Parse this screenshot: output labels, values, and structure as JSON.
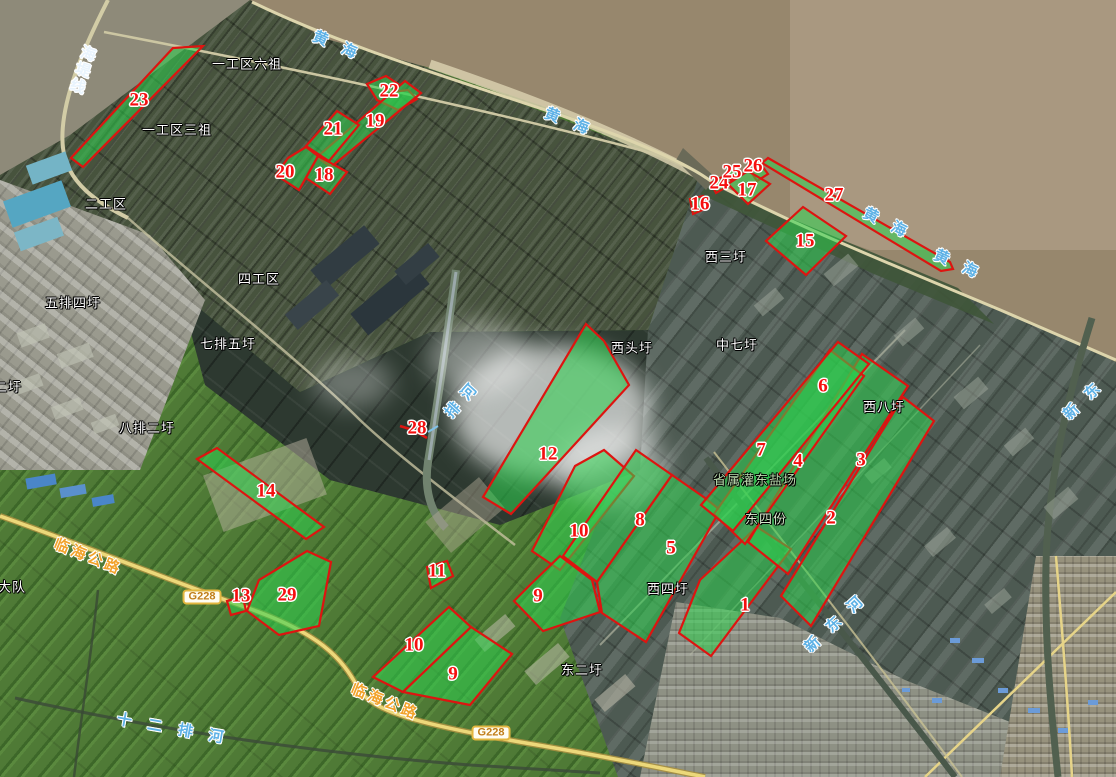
{
  "map": {
    "title": "灌东盐场卫星影像分布图",
    "colors": {
      "parcel_fill": "#2ed24e",
      "parcel_stroke": "#de1410",
      "marker_red": "#f50f0f",
      "water_label_blue": "#5fb2e6",
      "road_label_orange": "#f2a32c",
      "sea_brown": "#97876d",
      "sea_light_seam": "#ab9a82",
      "farmland_green": "#4f7a36",
      "highway_yellow": "#ecd87a"
    },
    "region_labels": [
      {
        "t": "一工区六祖",
        "x": 247,
        "y": 64
      },
      {
        "t": "一工区三祖",
        "x": 177,
        "y": 130
      },
      {
        "t": "二工区",
        "x": 106,
        "y": 204
      },
      {
        "t": "四工区",
        "x": 259,
        "y": 279
      },
      {
        "t": "五排四圩",
        "x": 73,
        "y": 303
      },
      {
        "t": "七排五圩",
        "x": 228,
        "y": 344
      },
      {
        "t": "八排二圩",
        "x": 147,
        "y": 428
      },
      {
        "t": "二圩",
        "x": 8,
        "y": 387
      },
      {
        "t": "西三圩",
        "x": 726,
        "y": 257
      },
      {
        "t": "西头圩",
        "x": 632,
        "y": 348
      },
      {
        "t": "中七圩",
        "x": 737,
        "y": 345
      },
      {
        "t": "西八圩",
        "x": 884,
        "y": 407
      },
      {
        "t": "省属灌东盐场",
        "x": 755,
        "y": 480,
        "c": "#b9d9ac"
      },
      {
        "t": "东四份",
        "x": 766,
        "y": 519,
        "c": "#d6e8cc"
      },
      {
        "t": "西四圩",
        "x": 668,
        "y": 589
      },
      {
        "t": "东二圩",
        "x": 582,
        "y": 670
      },
      {
        "t": "大队",
        "x": 12,
        "y": 587
      }
    ],
    "water_labels": [
      {
        "t": "海堤线",
        "x": 82,
        "y": 70,
        "r": 18,
        "v": true,
        "ls": 2,
        "c": "#e9f4fd"
      },
      {
        "t": "黄海",
        "x": 342,
        "y": 48,
        "r": 23,
        "ls": 16
      },
      {
        "t": "黄海",
        "x": 574,
        "y": 124,
        "r": 21,
        "ls": 16
      },
      {
        "t": "黄海",
        "x": 892,
        "y": 226,
        "r": 26,
        "ls": 16
      },
      {
        "t": "黄海",
        "x": 963,
        "y": 267,
        "r": 24,
        "ls": 16
      },
      {
        "t": "排河",
        "x": 464,
        "y": 398,
        "r": -48,
        "ls": 9
      },
      {
        "t": "新东河",
        "x": 839,
        "y": 620,
        "r": -43,
        "ls": 14
      },
      {
        "t": "新东",
        "x": 1087,
        "y": 397,
        "r": -44,
        "ls": 14
      },
      {
        "t": "十二排河",
        "x": 178,
        "y": 730,
        "r": 10,
        "ls": 16
      }
    ],
    "road_labels": [
      {
        "t": "临海公路",
        "x": 88,
        "y": 557,
        "r": 22,
        "ls": 3
      },
      {
        "t": "临海公路",
        "x": 385,
        "y": 702,
        "r": 22,
        "ls": 3
      }
    ],
    "road_badges": [
      {
        "t": "G228",
        "x": 202,
        "y": 597
      },
      {
        "t": "G228",
        "x": 491,
        "y": 733
      }
    ],
    "markers": [
      {
        "n": "1",
        "x": 745,
        "y": 605
      },
      {
        "n": "2",
        "x": 831,
        "y": 518
      },
      {
        "n": "3",
        "x": 861,
        "y": 460
      },
      {
        "n": "4",
        "x": 798,
        "y": 461
      },
      {
        "n": "5",
        "x": 671,
        "y": 548
      },
      {
        "n": "6",
        "x": 823,
        "y": 386
      },
      {
        "n": "7",
        "x": 761,
        "y": 450
      },
      {
        "n": "8",
        "x": 640,
        "y": 520
      },
      {
        "n": "9",
        "x": 538,
        "y": 596
      },
      {
        "n": "9",
        "x": 453,
        "y": 674,
        "dup": "-b"
      },
      {
        "n": "10",
        "x": 579,
        "y": 531
      },
      {
        "n": "10",
        "x": 414,
        "y": 645,
        "dup": "-b"
      },
      {
        "n": "11",
        "x": 437,
        "y": 571
      },
      {
        "n": "12",
        "x": 548,
        "y": 454
      },
      {
        "n": "13",
        "x": 241,
        "y": 596
      },
      {
        "n": "14",
        "x": 266,
        "y": 491
      },
      {
        "n": "15",
        "x": 805,
        "y": 241
      },
      {
        "n": "16",
        "x": 700,
        "y": 204
      },
      {
        "n": "17",
        "x": 747,
        "y": 190
      },
      {
        "n": "18",
        "x": 324,
        "y": 175
      },
      {
        "n": "19",
        "x": 375,
        "y": 121
      },
      {
        "n": "20",
        "x": 285,
        "y": 172
      },
      {
        "n": "21",
        "x": 333,
        "y": 129
      },
      {
        "n": "22",
        "x": 389,
        "y": 91
      },
      {
        "n": "23",
        "x": 139,
        "y": 100
      },
      {
        "n": "24",
        "x": 719,
        "y": 183
      },
      {
        "n": "25",
        "x": 732,
        "y": 172
      },
      {
        "n": "26",
        "x": 753,
        "y": 166
      },
      {
        "n": "27",
        "x": 834,
        "y": 195
      },
      {
        "n": "28",
        "x": 417,
        "y": 428
      },
      {
        "n": "29",
        "x": 287,
        "y": 595
      }
    ],
    "parcels": [
      {
        "id": "23",
        "points": "173,48 203,46 83,167 71,158"
      },
      {
        "id": "22",
        "points": "367,84 386,76 398,84 392,92 408,90 417,99 398,110 377,100"
      },
      {
        "id": "19",
        "points": "405,81 421,93 331,167 317,157"
      },
      {
        "id": "21",
        "points": "337,111 359,125 329,161 306,146"
      },
      {
        "id": "18",
        "points": "318,156 347,172 330,194 306,178"
      },
      {
        "id": "20",
        "points": "288,158 306,147 318,156 299,190 276,175"
      },
      {
        "id": "27",
        "points": "762,163 768,158 950,262 953,269 941,271"
      },
      {
        "id": "26",
        "points": "751,172 762,166 768,174 757,181"
      },
      {
        "id": "25",
        "points": "727,172 737,166 742,174 731,180"
      },
      {
        "id": "24",
        "points": "711,183 722,177 728,186 716,193"
      },
      {
        "id": "17",
        "points": "748,171 770,184 748,204 728,184"
      },
      {
        "id": "16",
        "points": "690,199 703,196 707,208 693,214"
      },
      {
        "id": "15",
        "points": "803,207 846,236 806,275 766,241"
      },
      {
        "id": "28",
        "points": "400,426 413,430 427,438",
        "open": true
      },
      {
        "id": "12",
        "points": "586,324 604,341 629,385 511,514 483,497"
      },
      {
        "id": "14",
        "points": "197,459 217,448 324,527 306,539"
      },
      {
        "id": "29",
        "points": "307,551 331,562 319,626 279,635 247,611 259,580"
      },
      {
        "id": "13",
        "points": "227,601 243,597 246,611 231,615"
      },
      {
        "id": "11",
        "points": "427,567 447,561 453,576 431,588"
      },
      {
        "id": "10",
        "points": "575,466 604,450 634,476 560,570 532,551"
      },
      {
        "id": "8",
        "points": "636,450 672,475 597,582 563,556"
      },
      {
        "id": "5",
        "points": "672,475 705,498 720,510 646,642 602,613 597,582"
      },
      {
        "id": "9",
        "points": "560,556 592,580 600,612 543,631 514,601 531,584"
      },
      {
        "id": "1",
        "points": "757,527 791,549 711,656 679,633 700,580"
      },
      {
        "id": "2",
        "points": "903,397 934,421 811,626 781,596"
      },
      {
        "id": "3",
        "points": "862,354 908,386 788,574 748,542"
      },
      {
        "id": "4",
        "points": "830,350 864,376 745,544 714,514"
      },
      {
        "id": "6-7",
        "points": "838,342 869,364 733,531 701,505"
      },
      {
        "id": "10-b",
        "points": "449,607 471,627 403,692 373,677"
      },
      {
        "id": "9-b",
        "points": "471,627 512,654 470,705 403,692"
      }
    ]
  }
}
